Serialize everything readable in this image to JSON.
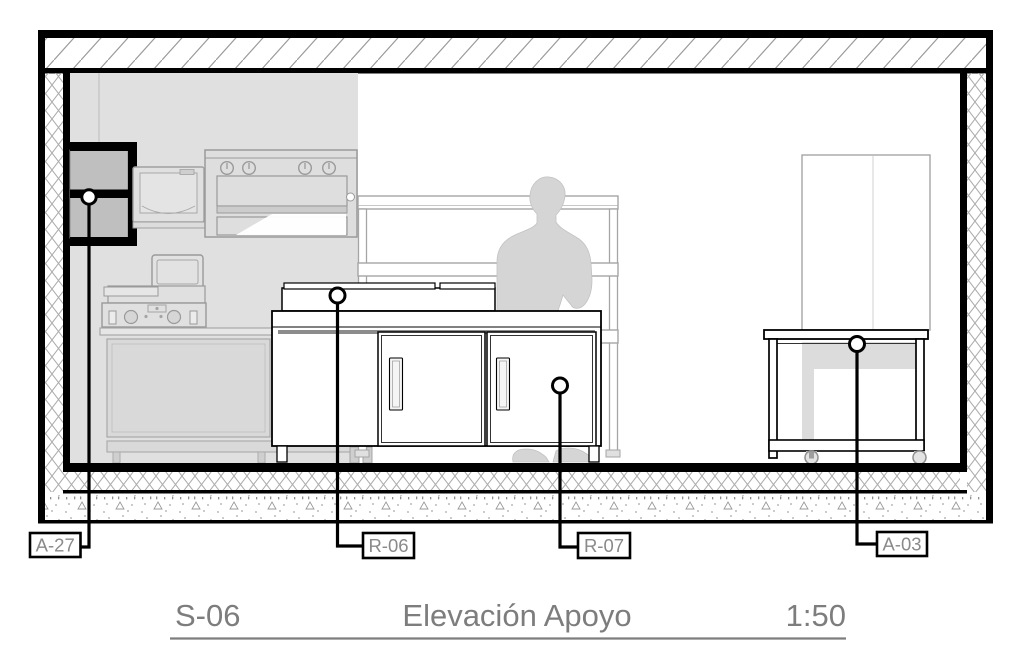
{
  "title": {
    "code": "S-06",
    "name": "Elevación Apoyo",
    "scale": "1:50"
  },
  "callouts": {
    "a27": {
      "label": "A-27",
      "target": "wall-cabinet"
    },
    "r06": {
      "label": "R-06",
      "target": "counter-top-equipment"
    },
    "r07": {
      "label": "R-07",
      "target": "counter-door-right"
    },
    "a03": {
      "label": "A-03",
      "target": "service-table"
    }
  },
  "colors": {
    "line_black": "#000000",
    "label_text": "#8a8a8a",
    "title_text": "#7d7d7d",
    "interior_gray": "#e0e0e0",
    "equipment_outline": "#9a9a9a",
    "silhouette_gray": "#d5d5d5",
    "hatch_gray": "#999999"
  }
}
